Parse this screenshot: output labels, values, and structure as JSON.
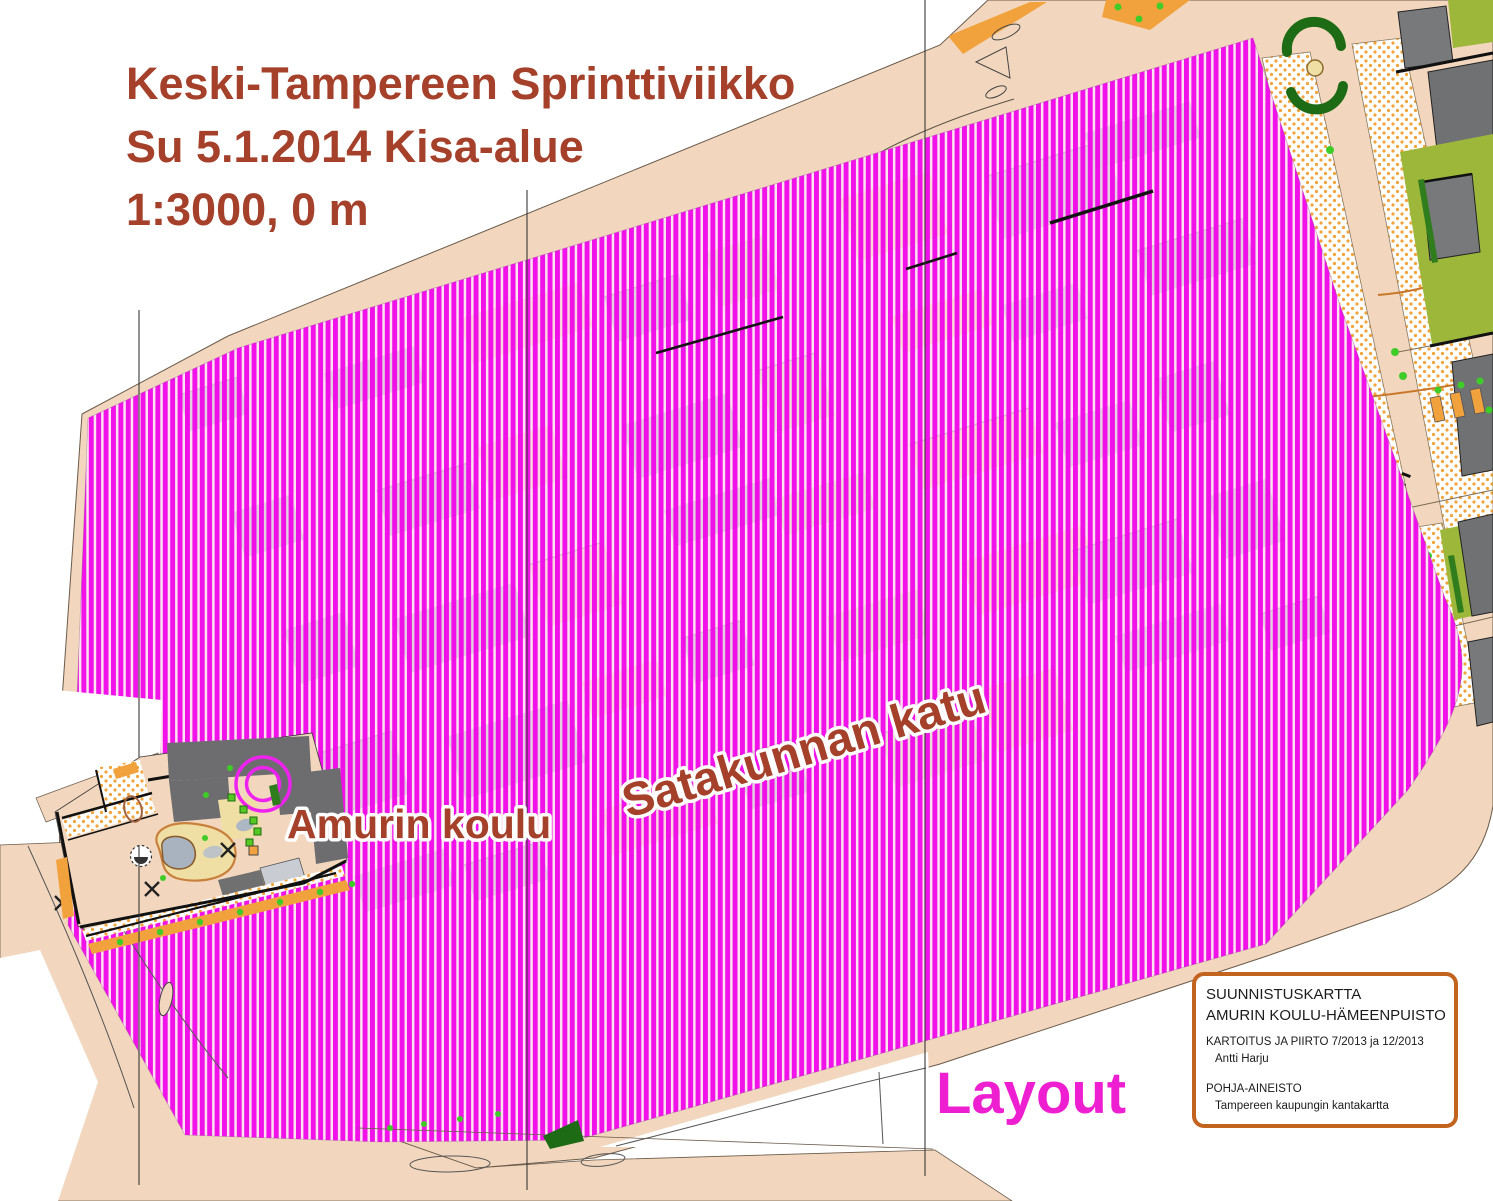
{
  "title": {
    "line1": "Keski-Tampereen Sprinttiviikko",
    "line2": "Su 5.1.2014 Kisa-alue",
    "line3": "1:3000, 0 m"
  },
  "map_labels": {
    "school": "Amurin koulu",
    "street": "Satakunnan katu",
    "layout": "Layout"
  },
  "legend_box": {
    "title_line1": "SUUNNISTUSKARTTA",
    "title_line2": "AMURIN KOULU-HÄMEENPUISTO",
    "survey_heading": "KARTOITUS JA PIIRTO 7/2013 ja 12/2013",
    "surveyor": "Antti Harju",
    "base_heading": "POHJA-AINEISTO",
    "base_source": "Tampereen kaupungin kantakartta"
  },
  "colors": {
    "title_text": "#A5402B",
    "restricted_area_stripe": "#EF04E8",
    "layout_text": "#EE1FD0",
    "land_tan": "#F2D7BE",
    "legend_border": "#C2641E",
    "building_gray": "#6F7173",
    "olive_green": "#9DB73B",
    "orange_open": "#F2A23C",
    "tree_green": "#3FCC28",
    "hedge_green": "#1E6B15",
    "control_circle": "#EE22EE"
  }
}
